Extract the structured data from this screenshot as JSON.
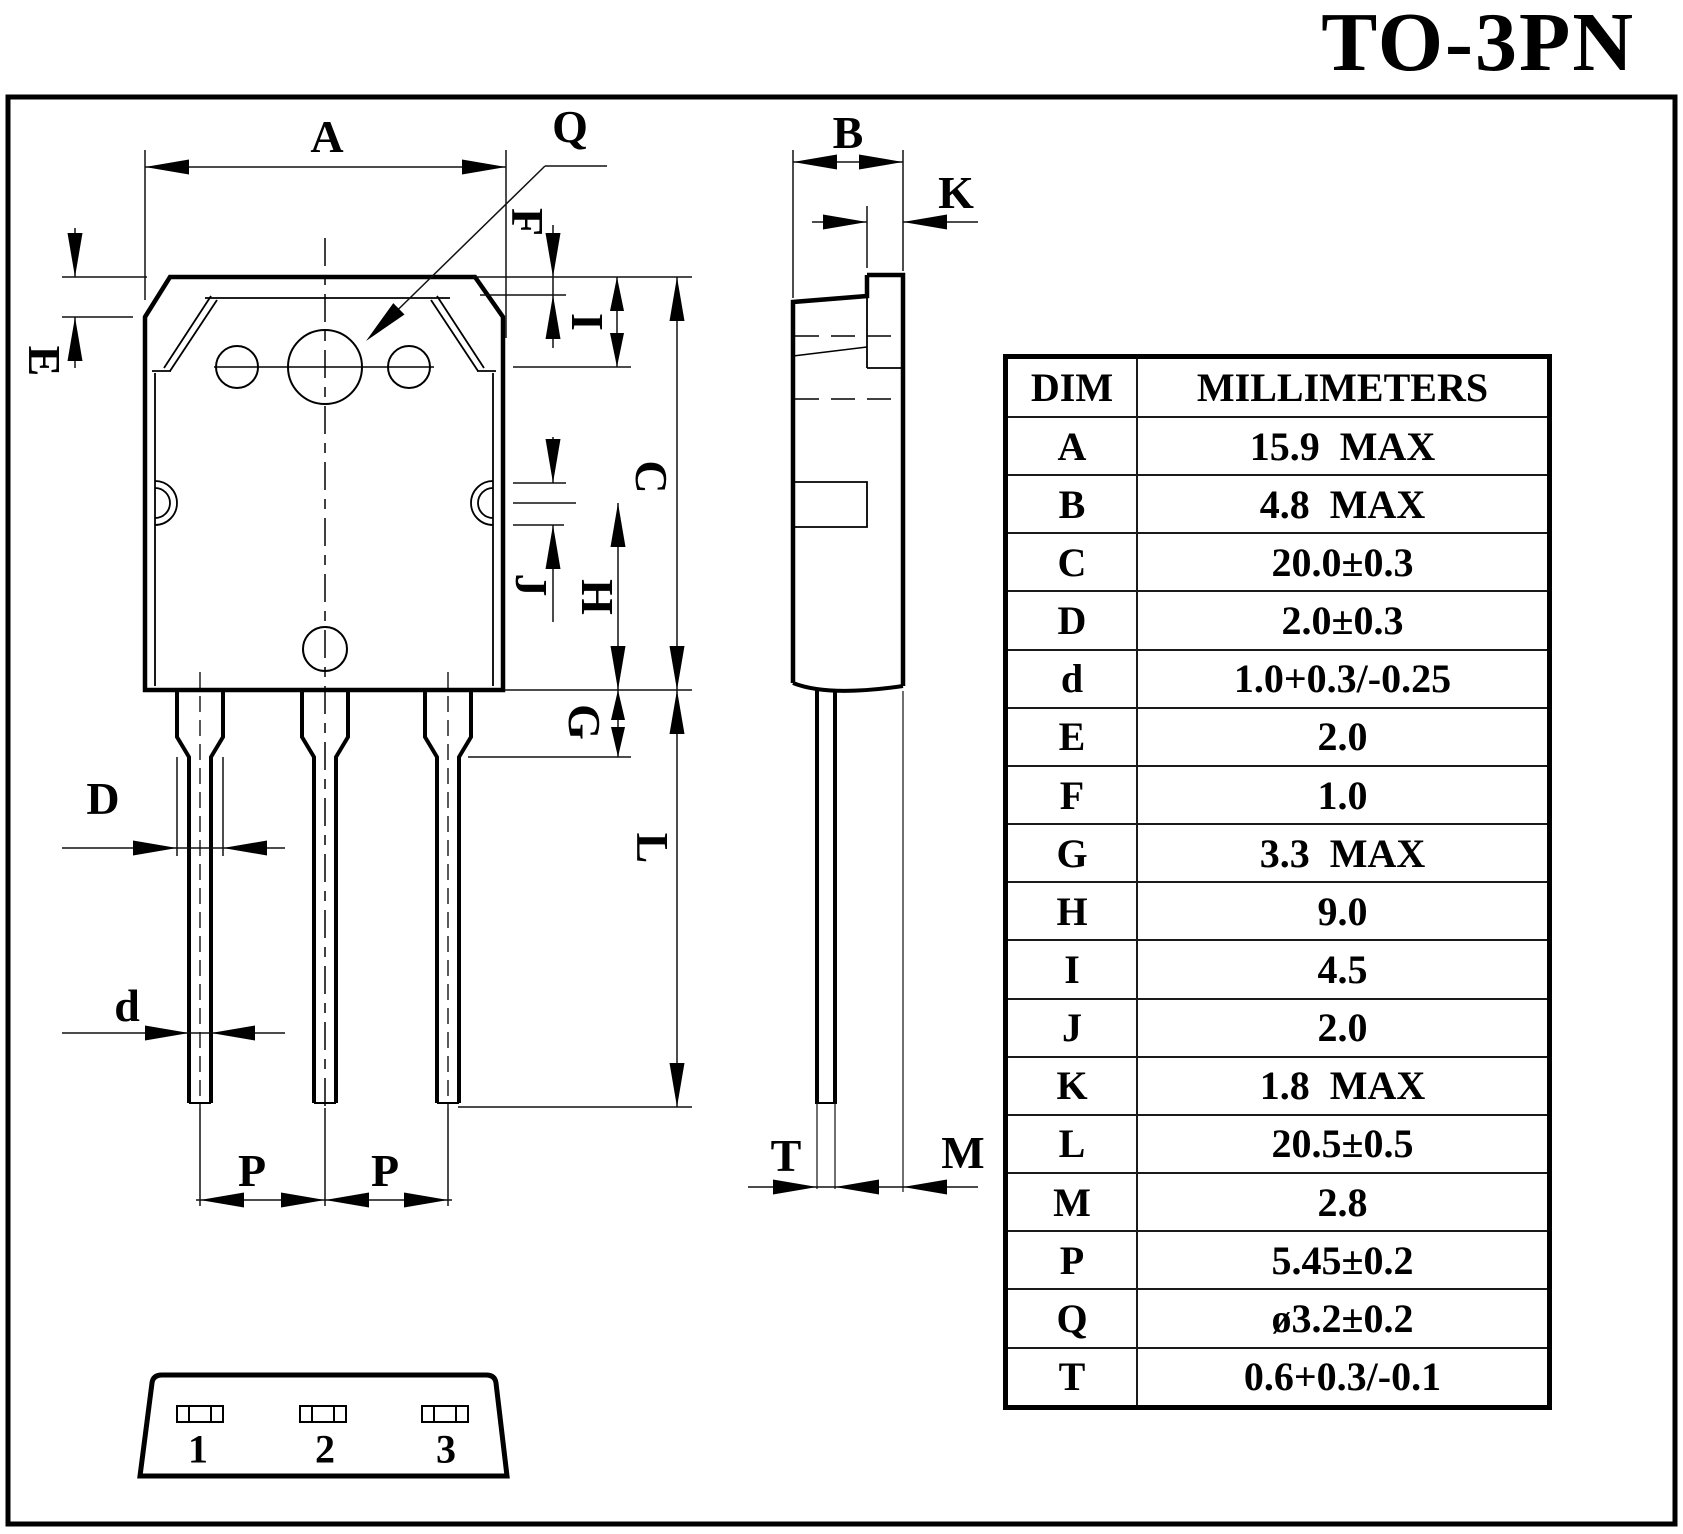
{
  "window": {
    "title": "TO-3PN"
  },
  "dimension_table": {
    "headers": [
      "DIM",
      "MILLIMETERS"
    ],
    "rows": [
      {
        "dim": "A",
        "mm": "15.9  MAX"
      },
      {
        "dim": "B",
        "mm": "4.8  MAX"
      },
      {
        "dim": "C",
        "mm": "20.0±0.3"
      },
      {
        "dim": "D",
        "mm": "2.0±0.3"
      },
      {
        "dim": "d",
        "mm": "1.0+0.3/-0.25"
      },
      {
        "dim": "E",
        "mm": "2.0"
      },
      {
        "dim": "F",
        "mm": "1.0"
      },
      {
        "dim": "G",
        "mm": "3.3  MAX"
      },
      {
        "dim": "H",
        "mm": "9.0"
      },
      {
        "dim": "I",
        "mm": "4.5"
      },
      {
        "dim": "J",
        "mm": "2.0"
      },
      {
        "dim": "K",
        "mm": "1.8  MAX"
      },
      {
        "dim": "L",
        "mm": "20.5±0.5"
      },
      {
        "dim": "M",
        "mm": "2.8"
      },
      {
        "dim": "P",
        "mm": "5.45±0.2"
      },
      {
        "dim": "Q",
        "mm": "ø3.2±0.2"
      },
      {
        "dim": "T",
        "mm": "0.6+0.3/-0.1"
      }
    ]
  },
  "drawing": {
    "labels": {
      "a": "A",
      "q": "Q",
      "e": "E",
      "f": "F",
      "i": "I",
      "c": "C",
      "j": "J",
      "h": "H",
      "g": "G",
      "l": "L",
      "big_d": "D",
      "small_d": "d",
      "p_left": "P",
      "p_right": "P",
      "b": "B",
      "k": "K",
      "t": "T",
      "m": "M"
    },
    "pins": {
      "pin1": "1",
      "pin2": "2",
      "pin3": "3"
    }
  }
}
